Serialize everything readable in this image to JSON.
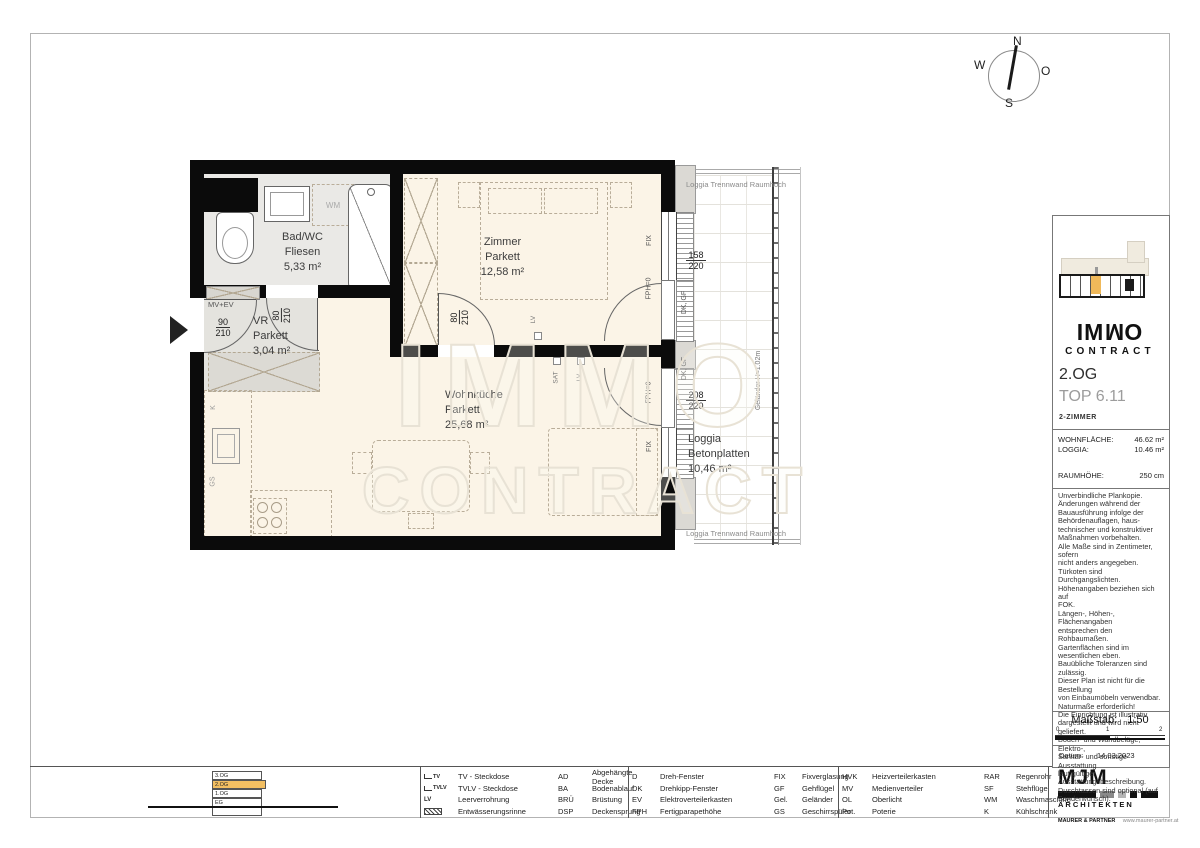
{
  "compass": {
    "n": "N",
    "e": "O",
    "s": "S",
    "w": "W"
  },
  "watermark": {
    "line1": "IMMO",
    "line2": "CONTRACT"
  },
  "plan": {
    "rooms": [
      {
        "name": "Bad/WC",
        "floor": "Fliesen",
        "area": "5,33 m²"
      },
      {
        "name": "VR",
        "floor": "Parkett",
        "area": "3,04 m²"
      },
      {
        "name": "Zimmer",
        "floor": "Parkett",
        "area": "12,58 m²"
      },
      {
        "name": "Wohnküche",
        "floor": "Parkett",
        "area": "25,68 m²"
      },
      {
        "name": "Loggia",
        "floor": "Betonplatten",
        "area": "10,46 m²"
      }
    ],
    "annotations": {
      "mv_ev": "MV+EV",
      "wm": "WM",
      "k": "K",
      "gs": "GS",
      "sat": "SAT",
      "lv": "LV",
      "lv_zimmer": "LV",
      "fix_zimmer": "FIX",
      "fix_wk": "FIX",
      "fph_zimmer": "FPH=0",
      "fph_wk": "FPH=0",
      "dk_gf_zimmer": "DK, GF",
      "dk_gf_wk": "DK, GF",
      "partition_top": "Loggia Trennwand Raumhoch",
      "partition_bottom": "Loggia Trennwand Raumhoch",
      "railing": "Geländer H=1.02m"
    },
    "dimensions": {
      "entrance_w": "90",
      "entrance_h": "210",
      "bad_door_w": "80",
      "bad_door_h": "210",
      "zimmer_door_w": "80",
      "zimmer_door_h": "210",
      "zimmer_window_w": "158",
      "zimmer_window_h": "220",
      "wk_window_w": "208",
      "wk_window_h": "220"
    }
  },
  "sidebar": {
    "logo_line1": "IMMO",
    "logo_line2": "CONTRACT",
    "floor": "2.OG",
    "unit": "TOP 6.11",
    "unit_type": "2-ZIMMER",
    "metrics": [
      {
        "label": "WOHNFLÄCHE:",
        "value": "46.62 m²"
      },
      {
        "label": "LOGGIA:",
        "value": "10.46 m²"
      },
      {
        "label": "RAUMHÖHE:",
        "value": "250 cm"
      }
    ],
    "disclaimer": "Unverbindliche Plankopie.\nÄnderungen während der\nBauausführung infolge der\nBehördenauflagen, haus-\ntechnischer und konstruktiver\nMaßnahmen vorbehalten.\nAlle Maße sind in Zentimeter, sofern\nnicht anders angegeben.\nTürkoten sind Durchgangslichten.\nHöhenangaben beziehen sich auf\nFOK.\nLängen-, Höhen-, Flächenangaben\nentsprechen den Rohbaumaßen.\nGartenflächen sind im wesentlichen eben.\nBauübliche Toleranzen sind zulässig.\nDieser Plan ist nicht für die Bestellung\nvon Einbaumöbeln verwendbar.\nNaturmaße erforderlich!\nDie Einrichtung ist illustrativ\ndargestellt und wird nicht geliefert.\nBoden- und Wandbeläge, Elektro-,\nSanitär- und sonstige Ausstattung\nlaut gültiger\nAusstattungsbeschreibung.\nDuschtassen sind optional (auf\nSonderwunsch).",
    "scale_label": "Maßstab:",
    "scale_value": "1:50",
    "scale_ticks": [
      "0",
      "1",
      "2"
    ],
    "date_label": "Datum:",
    "date_value": "14.03.2023"
  },
  "floor_selector": {
    "floors": [
      "3.OG",
      "2.OG",
      "1.OG",
      "EG"
    ]
  },
  "legend": {
    "symbols": {
      "tv": "TV",
      "tvlv": "TVLV",
      "lv": "LV"
    },
    "cells": [
      {
        "left": [
          [
            "",
            "TV - Steckdose"
          ],
          [
            "",
            "TVLV - Steckdose"
          ],
          [
            "",
            "Leerverrohrung"
          ],
          [
            "",
            "Entwässerungsrinne"
          ]
        ],
        "right": [
          [
            "AD",
            "Abgehängte Decke"
          ],
          [
            "BA",
            "Bodenablauf"
          ],
          [
            "BRÜ",
            "Brüstung"
          ],
          [
            "DSP",
            "Deckensprung"
          ]
        ]
      },
      {
        "left": [
          [
            "D",
            "Dreh-Fenster"
          ],
          [
            "DK",
            "Drehkipp-Fenster"
          ],
          [
            "EV",
            "Elektroverteilerkasten"
          ],
          [
            "FPH",
            "Fertigparapethöhe"
          ]
        ],
        "right": [
          [
            "FIX",
            "Fixverglasung"
          ],
          [
            "GF",
            "Gehflügel"
          ],
          [
            "Gel.",
            "Geländer"
          ],
          [
            "GS",
            "Geschirrspüler"
          ]
        ]
      },
      {
        "left": [
          [
            "HVK",
            "Heizverteilerkasten"
          ],
          [
            "MV",
            "Medienverteiler"
          ],
          [
            "OL",
            "Oberlicht"
          ],
          [
            "Pot.",
            "Poterie"
          ]
        ],
        "right": [
          [
            "RAR",
            "Regenrohr"
          ],
          [
            "SF",
            "Stehflügel"
          ],
          [
            "WM",
            "Waschmaschine"
          ],
          [
            "K",
            "Kühlschrank"
          ]
        ]
      }
    ]
  },
  "architect": {
    "name": "MJM",
    "line1": "ARCHITEKTEN",
    "line2": "MAURER & PARTNER",
    "website": "www.maurer-partner.at"
  }
}
